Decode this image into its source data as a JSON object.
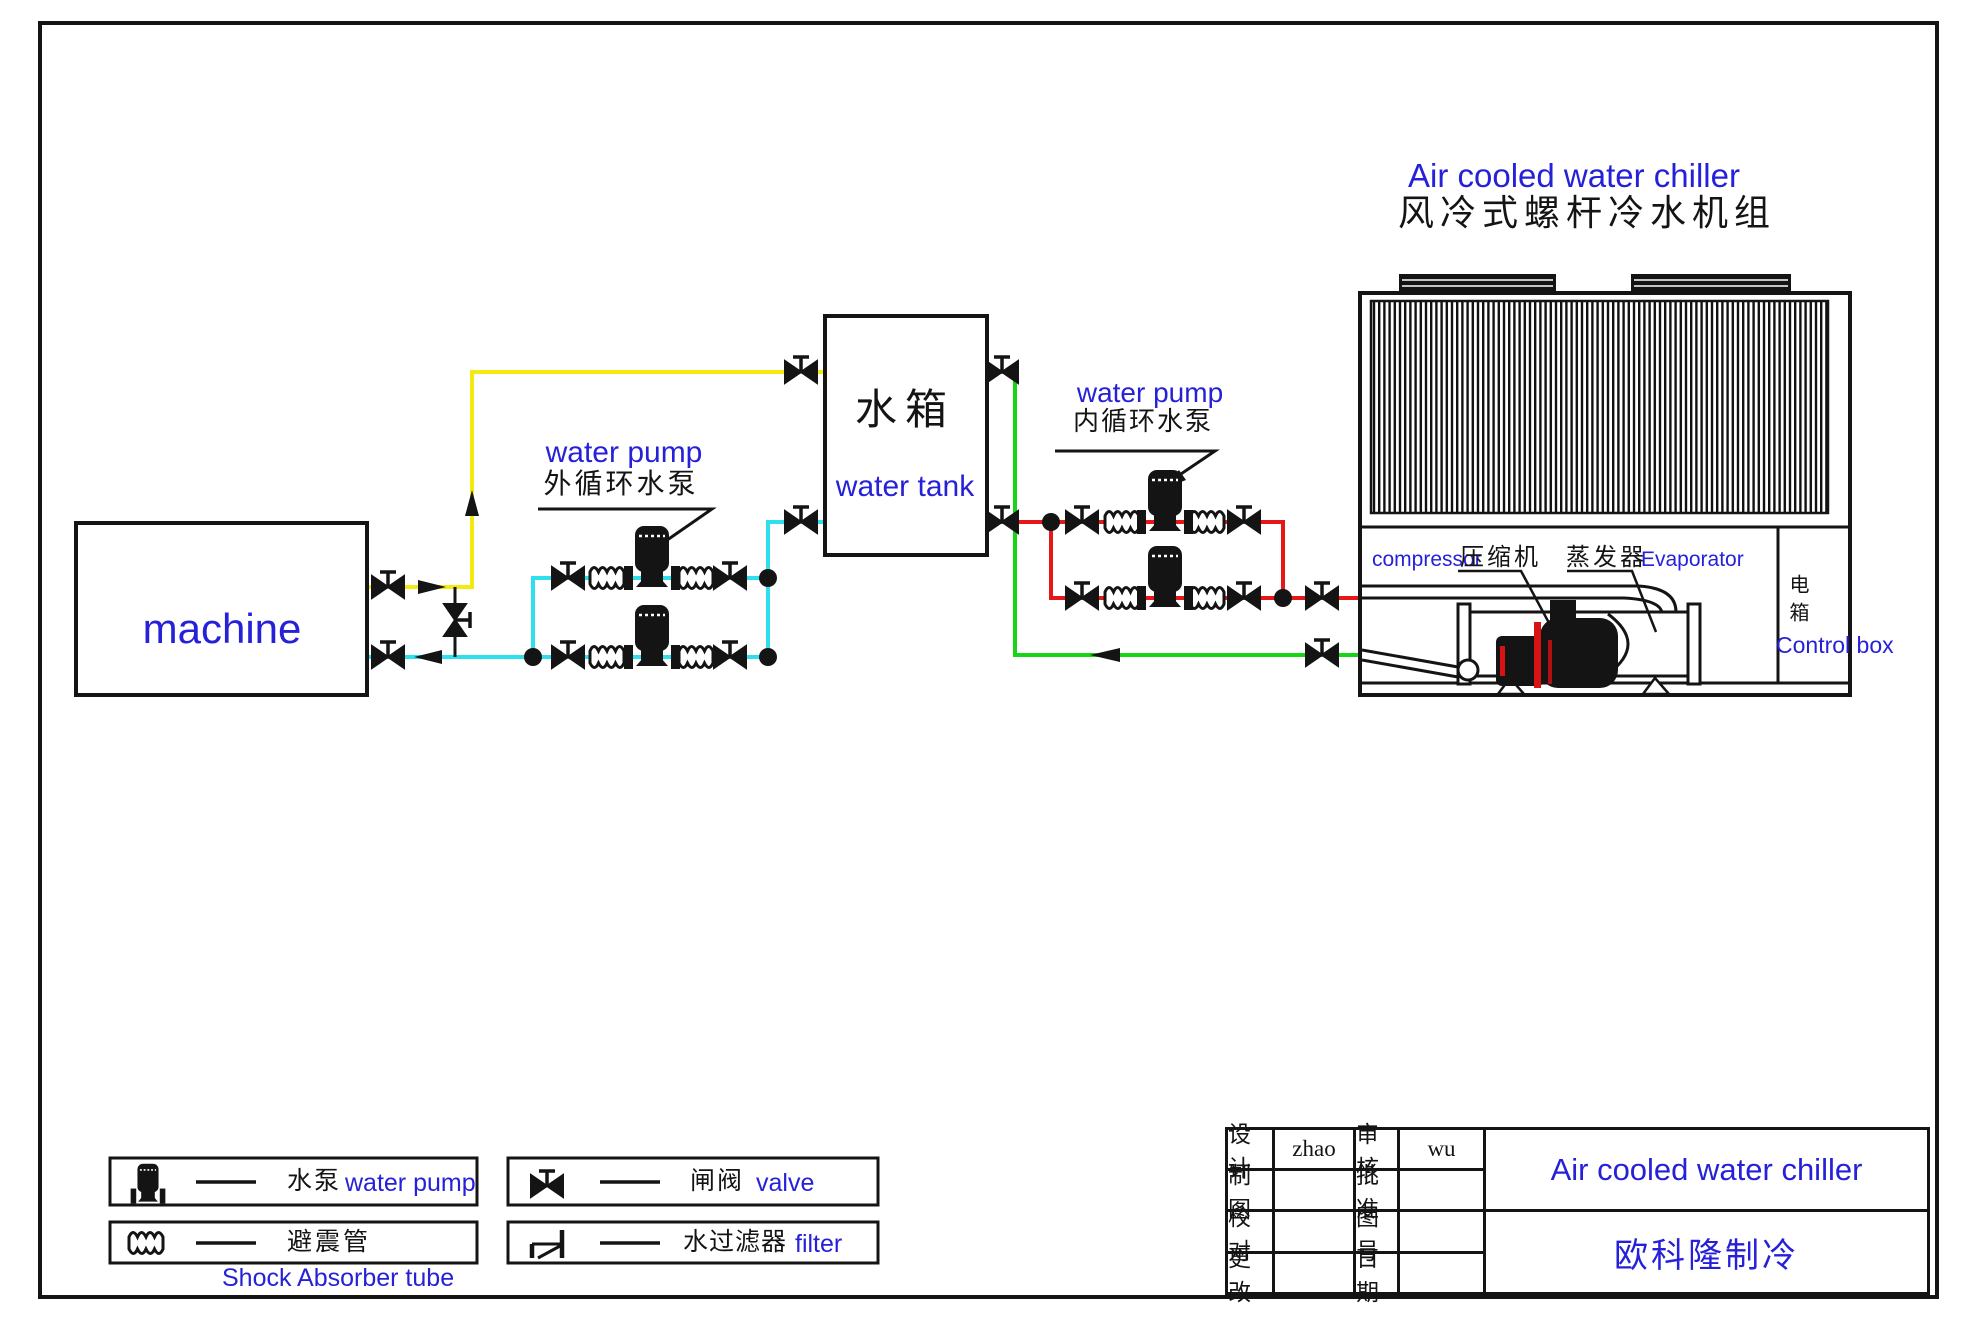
{
  "page": {
    "title_en": "Air cooled water chiller",
    "title_cn": "风冷式螺杆冷水机组"
  },
  "diagram": {
    "machine_label": "machine",
    "tank_label_cn": "水箱",
    "tank_label_en": "water tank",
    "external_pump_label_en": "water pump",
    "external_pump_label_cn": "外循环水泵",
    "internal_pump_label_en": "water pump",
    "internal_pump_label_cn": "内循环水泵",
    "compressor_label_en": "compressor",
    "compressor_label_cn": "压缩机",
    "evaporator_label_cn": "蒸发器",
    "evaporator_label_en": "Evaporator",
    "control_box_cn": "电箱",
    "control_box_en": "Control box"
  },
  "legend": {
    "items": [
      {
        "symbol": "pump-icon",
        "label_cn": "水泵",
        "label_en": "water pump"
      },
      {
        "symbol": "shock-absorber-icon",
        "label_cn": "避震管",
        "label_en": "Shock Absorber tube"
      },
      {
        "symbol": "valve-icon",
        "label_cn": "闸阀",
        "label_en": "valve"
      },
      {
        "symbol": "filter-icon",
        "label_cn": "水过滤器",
        "label_en": "filter"
      }
    ]
  },
  "title_block": {
    "rows": [
      {
        "label1": "设计",
        "value1": "zhao",
        "label2": "审核",
        "value2": "wu"
      },
      {
        "label1": "制图",
        "value1": "",
        "label2": "批准",
        "value2": ""
      },
      {
        "label1": "校对",
        "value1": "",
        "label2": "图号",
        "value2": ""
      },
      {
        "label1": "更改",
        "value1": "",
        "label2": "日期",
        "value2": ""
      }
    ],
    "product": "Air cooled water chiller",
    "company": "欧科隆制冷"
  },
  "colors": {
    "accent_blue": "#2621d8",
    "line_black": "#141414",
    "pipe_yellow": "#f3ea0f",
    "pipe_cyan": "#2fdfee",
    "pipe_green": "#17d417",
    "pipe_red": "#e51717"
  }
}
